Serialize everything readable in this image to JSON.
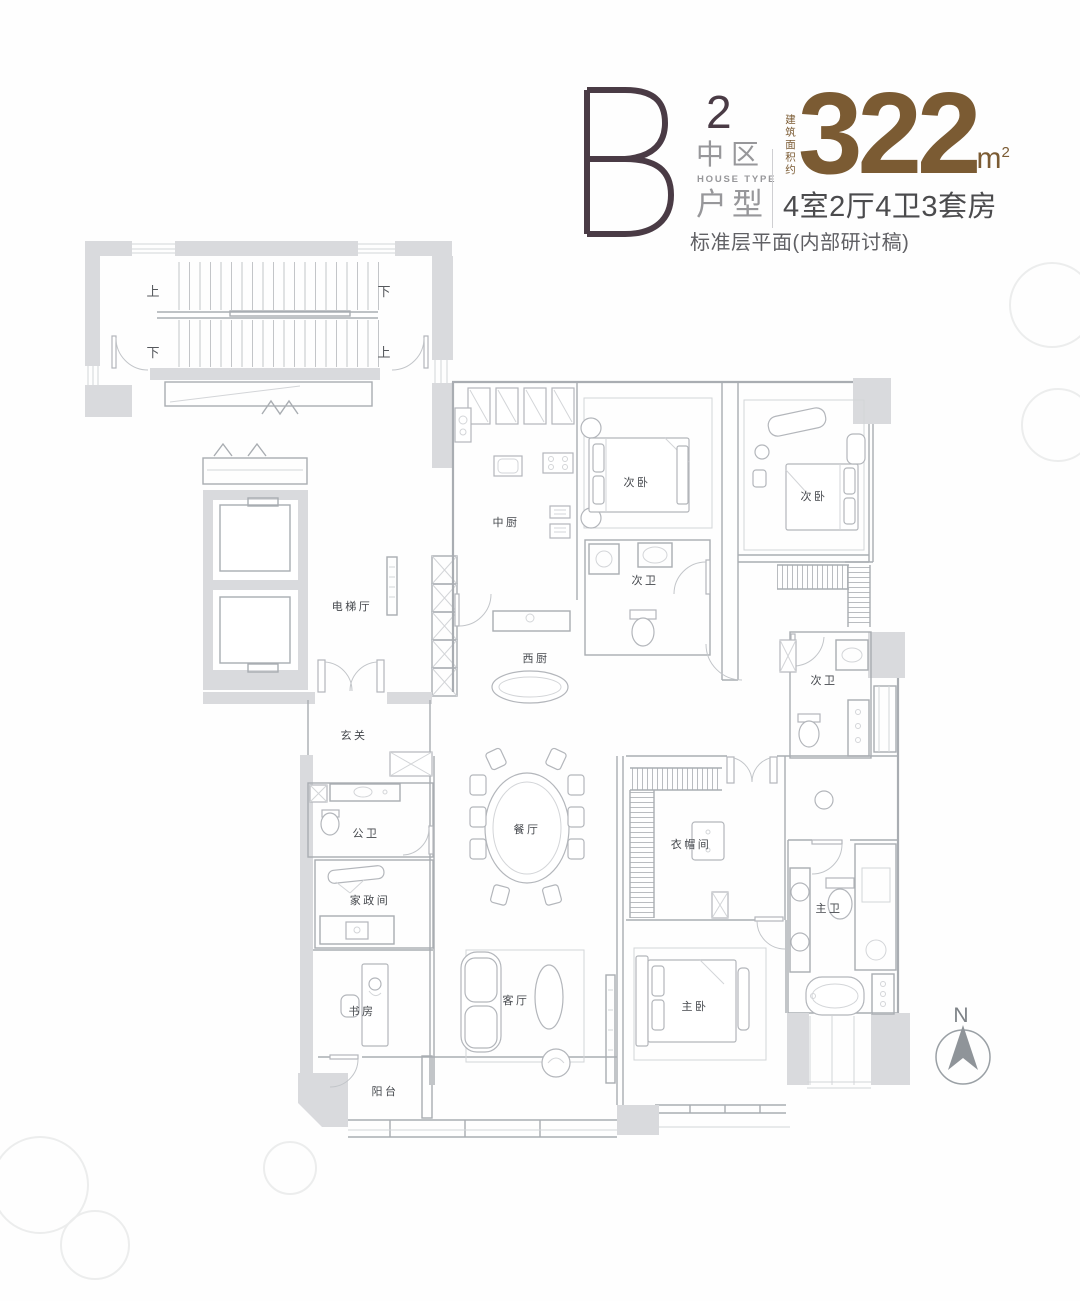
{
  "header": {
    "unit_letter": "B",
    "unit_sup": "2",
    "zone": "中区",
    "zone_en": "HOUSE TYPE",
    "type_label": "户型",
    "area_note": "建筑面积约",
    "area_value": "322",
    "area_unit": "m",
    "area_unit_sup": "2",
    "layout_spec": "4室2厅4卫3套房",
    "plan_note": "标准层平面(内部研讨稿)",
    "colors": {
      "letter": "#4a3b45",
      "area": "#7b5b33",
      "gray": "#97979a",
      "dark": "#4b4b4d"
    }
  },
  "floorplan": {
    "room_labels": [
      {
        "id": "elevator-hall",
        "label": "电梯厅",
        "x": 352,
        "y": 610,
        "size": 11
      },
      {
        "id": "kitchen-chinese",
        "label": "中厨",
        "x": 506,
        "y": 526,
        "size": 11
      },
      {
        "id": "kitchen-western",
        "label": "西厨",
        "x": 536,
        "y": 662,
        "size": 11
      },
      {
        "id": "bedroom-2-mid",
        "label": "次卧",
        "x": 637,
        "y": 486,
        "size": 11
      },
      {
        "id": "bath-2-mid",
        "label": "次卫",
        "x": 645,
        "y": 584,
        "size": 11
      },
      {
        "id": "bedroom-2-right",
        "label": "次卧",
        "x": 814,
        "y": 500,
        "size": 11
      },
      {
        "id": "bath-2-right",
        "label": "次卫",
        "x": 824,
        "y": 684,
        "size": 11
      },
      {
        "id": "foyer",
        "label": "玄关",
        "x": 354,
        "y": 739,
        "size": 11
      },
      {
        "id": "guest-bath",
        "label": "公卫",
        "x": 366,
        "y": 837,
        "size": 11
      },
      {
        "id": "dining-room",
        "label": "餐厅",
        "x": 527,
        "y": 833,
        "size": 11
      },
      {
        "id": "housekeeping",
        "label": "家政间",
        "x": 370,
        "y": 904,
        "size": 11
      },
      {
        "id": "cloakroom",
        "label": "衣帽间",
        "x": 691,
        "y": 848,
        "size": 11
      },
      {
        "id": "master-bath",
        "label": "主卫",
        "x": 829,
        "y": 912,
        "size": 11
      },
      {
        "id": "study",
        "label": "书房",
        "x": 362,
        "y": 1015,
        "size": 11
      },
      {
        "id": "living-room",
        "label": "客厅",
        "x": 516,
        "y": 1004,
        "size": 11
      },
      {
        "id": "master-bedroom",
        "label": "主卧",
        "x": 695,
        "y": 1010,
        "size": 11
      },
      {
        "id": "balcony",
        "label": "阳台",
        "x": 385,
        "y": 1095,
        "size": 11
      }
    ],
    "stair_labels": [
      {
        "id": "stair-up-left",
        "label": "上",
        "x": 153,
        "y": 296
      },
      {
        "id": "stair-down-right",
        "label": "下",
        "x": 384,
        "y": 296
      },
      {
        "id": "stair-down-left",
        "label": "下",
        "x": 153,
        "y": 357
      },
      {
        "id": "stair-up-right",
        "label": "上",
        "x": 384,
        "y": 357
      }
    ],
    "compass": {
      "label": "N",
      "x": 961,
      "y": 1022
    }
  }
}
